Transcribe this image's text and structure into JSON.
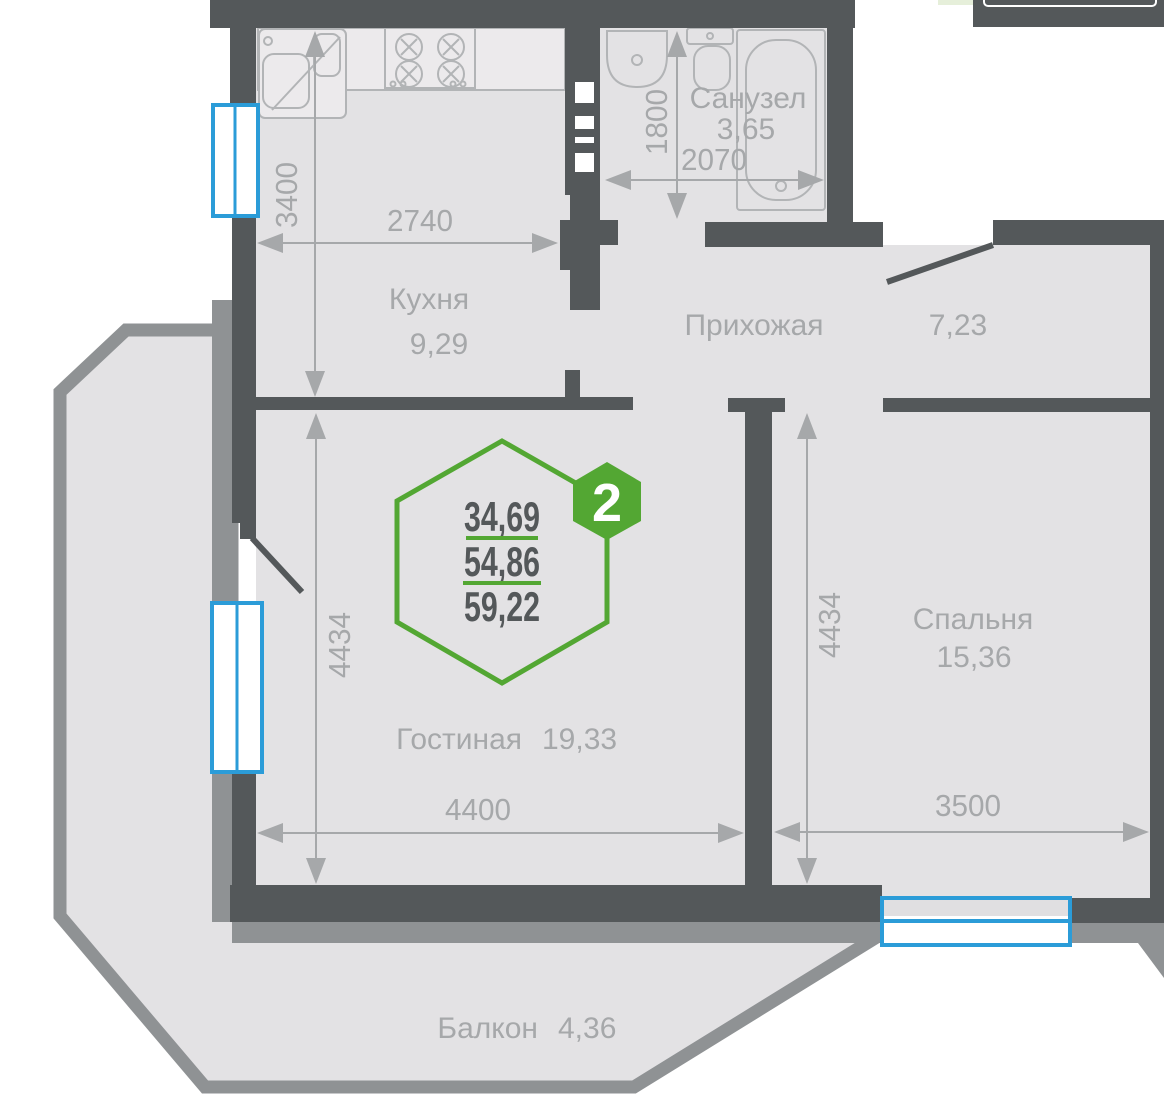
{
  "plan": {
    "badge": {
      "number": "2",
      "values": [
        "34,69",
        "54,86",
        "59,22"
      ]
    },
    "rooms": {
      "kitchen": {
        "name": "Кухня",
        "area": "9,29"
      },
      "bathroom": {
        "name": "Санузел",
        "area": "3,65"
      },
      "hallway": {
        "name": "Прихожая",
        "area": "7,23"
      },
      "living": {
        "name": "Гостиная",
        "area": "19,33"
      },
      "bedroom": {
        "name": "Спальня",
        "area": "15,36"
      },
      "balcony": {
        "name": "Балкон",
        "area": "4,36"
      }
    },
    "dims": {
      "kitchen_w": "2740",
      "kitchen_h": "3400",
      "bath_w": "2070",
      "bath_h": "1800",
      "living_w": "4400",
      "living_h": "4434",
      "bedroom_w": "3500",
      "bedroom_h": "4434"
    },
    "colors": {
      "wall": "#54585a",
      "balcony_gray": "#8f9294",
      "floor": "#e3e2e4",
      "window_blue": "#2b9cd8",
      "accent_green": "#53a733",
      "label_gray": "#a6a8aa"
    }
  }
}
